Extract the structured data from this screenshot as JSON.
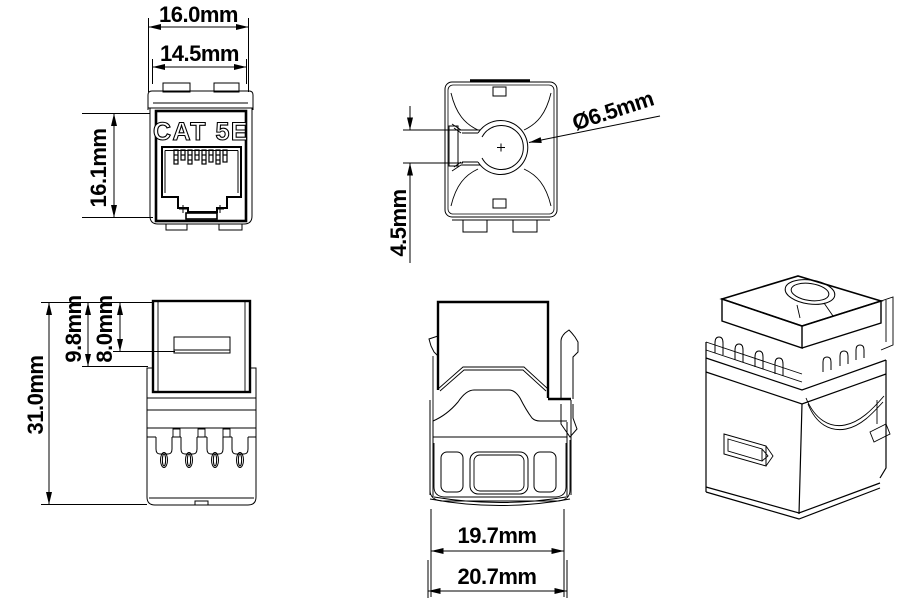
{
  "views": {
    "front": {
      "marking": "CAT 5E",
      "dim_outer_width": "16.0mm",
      "dim_inner_width": "14.5mm",
      "dim_face_height": "16.1mm"
    },
    "top": {
      "dim_hole_diameter": "Ø6.5mm",
      "dim_hole_offset": "4.5mm"
    },
    "side": {
      "dim_overall_height": "31.0mm",
      "dim_upper_section": "9.8mm",
      "dim_window_offset": "8.0mm"
    },
    "rear": {
      "dim_inner_width": "19.7mm",
      "dim_outer_width": "20.7mm"
    },
    "colors": {
      "line_color": "#000000",
      "background_color": "#ffffff"
    }
  }
}
